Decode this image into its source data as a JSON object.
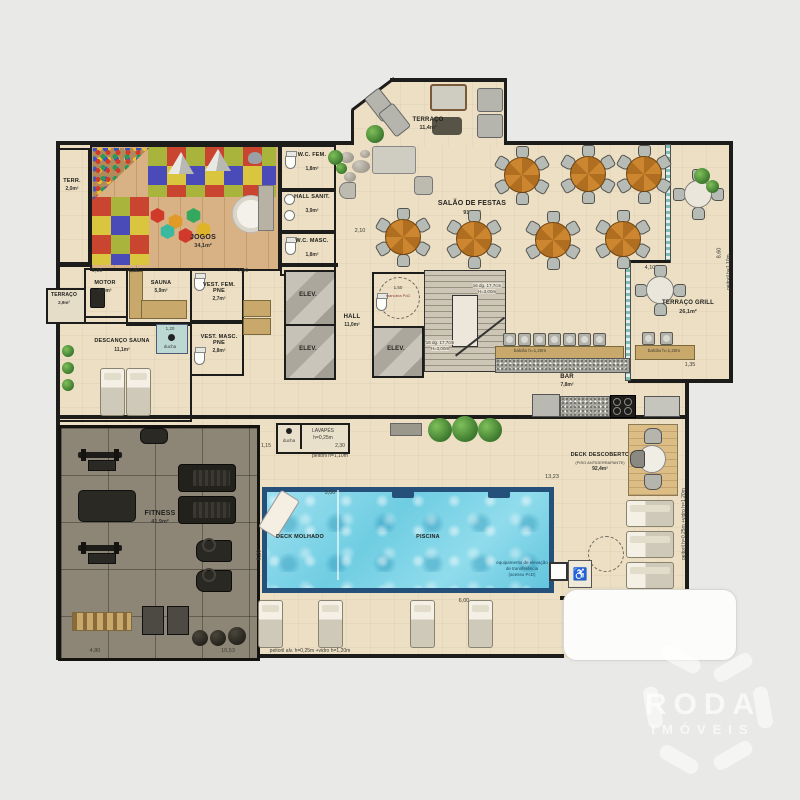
{
  "watermark": {
    "line1": "RODA",
    "line2": "IMÓVEIS"
  },
  "rooms": {
    "terraco_top": {
      "label": "TERRAÇO",
      "area": "11,4m²"
    },
    "jogos": {
      "label": "JOGOS",
      "area": "34,1m²"
    },
    "terr": {
      "label": "TERR.",
      "area": "2,0m²"
    },
    "wc_fem": {
      "label": "W.C. FEM.",
      "area": "1,8m²"
    },
    "hall_sanit": {
      "label": "HALL SANIT.",
      "area": "3,9m²"
    },
    "wc_masc": {
      "label": "W.C. MASC.",
      "area": "1,8m²"
    },
    "salao": {
      "label": "SALÃO DE FESTAS",
      "area": "91,9m²"
    },
    "terraco_grill": {
      "label": "TERRAÇO GRILL",
      "area": "26,1m²"
    },
    "motor": {
      "label": "MOTOR",
      "area": "2,3m²"
    },
    "sauna": {
      "label": "SAUNA",
      "area": "5,9m²"
    },
    "vest_fem": {
      "label": "VEST. FEM. PNE",
      "area": "2,7m²"
    },
    "vest_masc": {
      "label": "VEST. MASC. PNE",
      "area": "2,8m²"
    },
    "terraco_esq": {
      "label": "TERRAÇO",
      "area": "2,9m²"
    },
    "descanso": {
      "label": "DESCANÇO SAUNA",
      "area": "11,1m²"
    },
    "elev": {
      "label": "ELEV."
    },
    "hall": {
      "label": "HALL",
      "area": "11,0m²"
    },
    "bar": {
      "label": "BAR",
      "area": "7,8m²"
    },
    "fitness": {
      "label": "FITNESS",
      "area": "41,9m²"
    },
    "deck_molhado": {
      "label": "DECK MOLHADO"
    },
    "piscina": {
      "label": "PISCINA"
    },
    "deck_desc": {
      "label": "DECK DESCOBERTO",
      "sub": "(PISO ANTIDERRAPANTE)",
      "area": "92,4m²"
    }
  },
  "annotations": {
    "balcao": "balcão h=1,20m",
    "peitoril110": "peitoril h=1,10m",
    "peitoril_vidro": "peitoril h=0,25m +vidro h=1,20m",
    "peitoril_alv": "peitoril alv. h=0,25m +vidro h=1,20m",
    "lavapes1": "LAVAPÉS",
    "lavapes2": "h=0,25m",
    "ducha": "ducha",
    "stairs1": "16 dg. 17,7cm",
    "stairs2": "H=3,00m",
    "pcd": "manobra PcD",
    "lift1": "equipamento de elevação",
    "lift2": "de transferência",
    "lift3": "(acesso PcD)"
  },
  "dims": [
    "1,10",
    "2,80",
    "7,50",
    "2,10",
    "13,23",
    "5,00",
    "8,20",
    "6,00",
    "1,15",
    "2,30",
    "1,20",
    "4,10",
    "8,60",
    "4,80",
    "10,53",
    "1,35",
    "1,50"
  ]
}
